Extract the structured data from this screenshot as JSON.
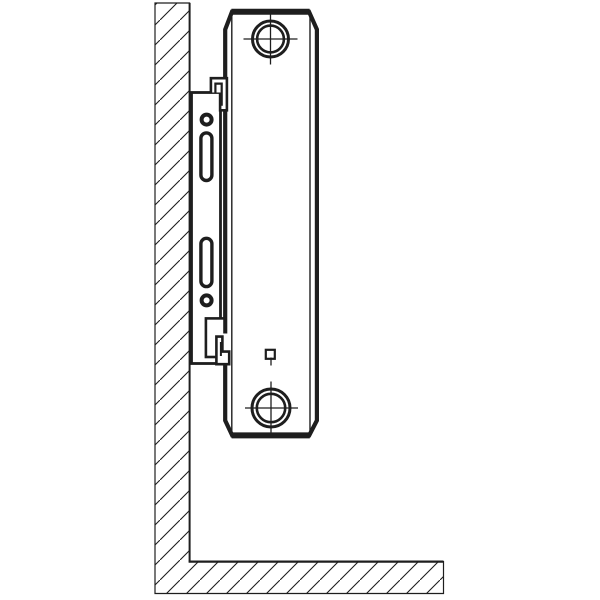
{
  "figure": {
    "type": "technical-line-drawing",
    "subject": "panel radiator side view on wall mounting bracket",
    "ink_color": "#1e1e1e",
    "paper_color": "#ffffff",
    "hatch_spacing_px": 20,
    "components": [
      {
        "name": "wall-section",
        "style": "diagonal-hatch"
      },
      {
        "name": "floor-section",
        "style": "diagonal-hatch"
      },
      {
        "name": "bracket-plate",
        "style": "outline"
      },
      {
        "name": "bracket-upper-fixing-hole",
        "style": "ring"
      },
      {
        "name": "bracket-upper-slot",
        "style": "rounded-slot"
      },
      {
        "name": "bracket-lower-slot",
        "style": "rounded-slot"
      },
      {
        "name": "bracket-lower-fixing-hole",
        "style": "ring"
      },
      {
        "name": "bracket-top-clip",
        "style": "stepped-hook"
      },
      {
        "name": "bracket-bottom-clip",
        "style": "stepped-hook"
      },
      {
        "name": "radiator-side-profile",
        "style": "thick-outline-chamfered"
      },
      {
        "name": "radiator-top-connection-port",
        "style": "crosshair-circle"
      },
      {
        "name": "radiator-bottom-connection-port",
        "style": "crosshair-circle"
      },
      {
        "name": "radiator-square-marker",
        "style": "small-square"
      }
    ]
  }
}
